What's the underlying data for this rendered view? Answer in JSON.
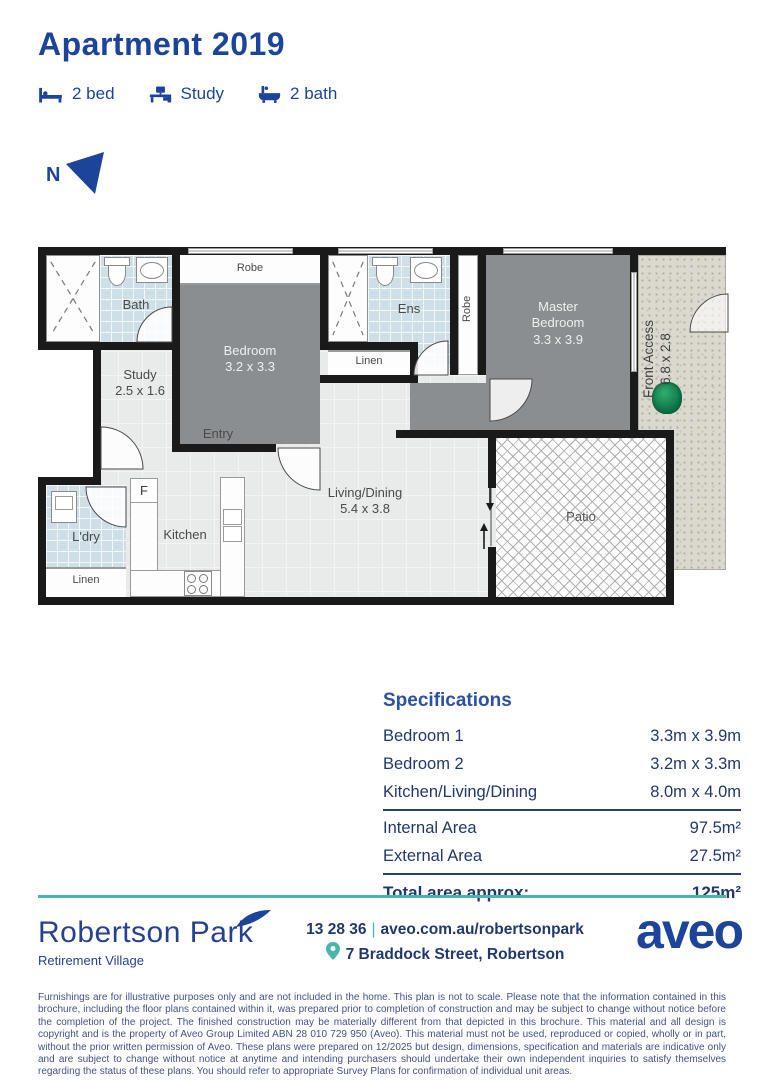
{
  "header": {
    "title": "Apartment 2019",
    "features": [
      {
        "icon": "bed-icon",
        "label": "2 bed"
      },
      {
        "icon": "desk-icon",
        "label": "Study"
      },
      {
        "icon": "bath-icon",
        "label": "2 bath"
      }
    ],
    "north_label": "N"
  },
  "floorplan": {
    "bath": "Bath",
    "robe_top": "Robe",
    "bedroom2_name": "Bedroom",
    "bedroom2_dims": "3.2 x 3.3",
    "study_name": "Study",
    "study_dims": "2.5 x 1.6",
    "entry": "Entry",
    "linen_mid": "Linen",
    "ens": "Ens",
    "robe_vertical": "Robe",
    "master_name": "Master Bedroom",
    "master_dims": "3.3 x 3.9",
    "front_access_name": "Front Access",
    "front_access_dims": "6.8 x 2.8",
    "ldry": "L'dry",
    "linen_bottom": "Linen",
    "kitchen": "Kitchen",
    "fridge": "F",
    "living_name": "Living/Dining",
    "living_dims": "5.4 x 3.8",
    "patio": "Patio"
  },
  "specifications": {
    "heading": "Specifications",
    "rows": [
      {
        "label": "Bedroom 1",
        "value": "3.3m x 3.9m"
      },
      {
        "label": "Bedroom 2",
        "value": "3.2m x 3.3m"
      },
      {
        "label": "Kitchen/Living/Dining",
        "value": "8.0m x 4.0m"
      }
    ],
    "areas": [
      {
        "label": "Internal Area",
        "value": "97.5m²"
      },
      {
        "label": "External Area",
        "value": "27.5m²"
      }
    ],
    "total": {
      "label": "Total area approx:",
      "value": "125m²"
    }
  },
  "footer": {
    "village_name": "Robertson Park",
    "village_subtitle": "Retirement Village",
    "phone": "13 28 36",
    "separator": "|",
    "website": "aveo.com.au/robertsonpark",
    "address": "7 Braddock Street, Robertson",
    "brand": "aveo"
  },
  "disclaimer": "Furnishings are for illustrative purposes only and are not included in the home. This plan is not to scale. Please note that the information contained in this brochure, including the floor plans contained within it, was prepared prior to completion of construction and may be subject to change without notice before the completion of the project. The finished construction may be materially different from that depicted in this brochure. This material and all design is copyright and is the property of Aveo Group Limited ABN 28 010 729 950 (Aveo). This material must not be used, reproduced or copied, wholly or in part, without the prior written permission of Aveo. These plans were prepared on 12/2025 but design, dimensions, specification and materials are indicative only and are subject to change without notice at anytime and intending purchasers should undertake their own independent inquiries to satisfy themselves regarding the status of these plans. You should refer to appropriate Survey Plans for confirmation of individual unit areas.",
  "colors": {
    "brand_navy": "#1c449b",
    "teal": "#4cb5ab",
    "bedroom_fill": "#8a8e91",
    "wet_area_fill": "#cfdfe8",
    "front_access_fill": "#dbd9cf",
    "wall": "#1a1a1a"
  }
}
